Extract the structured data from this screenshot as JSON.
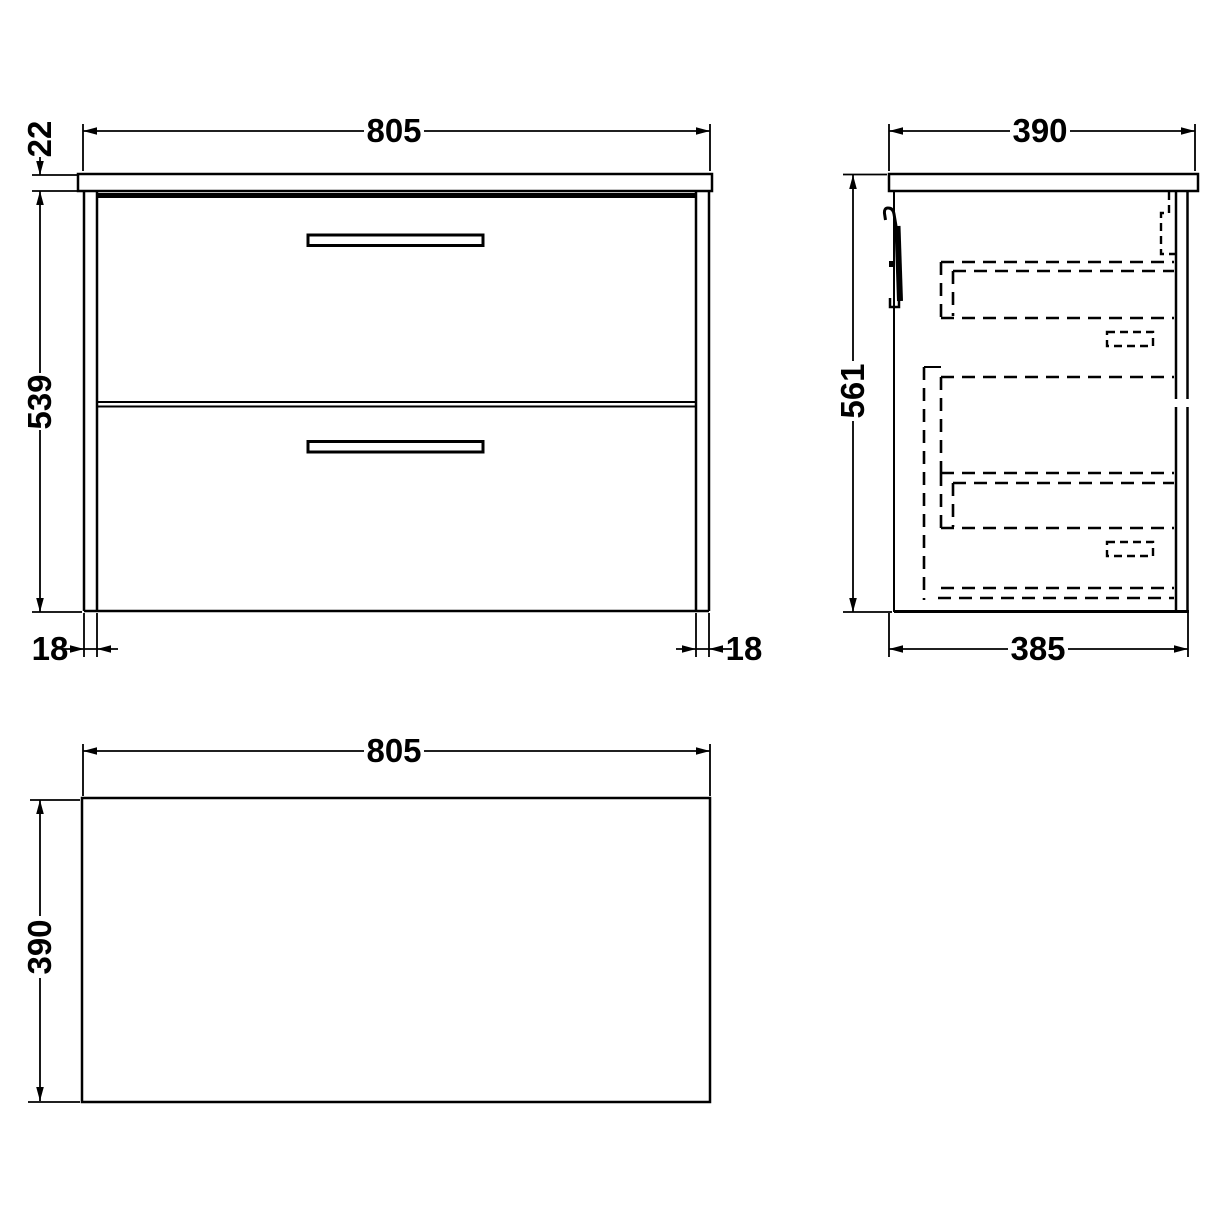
{
  "colors": {
    "line": "#000000",
    "background": "#ffffff"
  },
  "views": {
    "front": {
      "dims": {
        "width": "805",
        "worktop_thickness": "22",
        "cabinet_height": "539",
        "left_panel_thickness": "18",
        "right_panel_thickness": "18"
      }
    },
    "side": {
      "dims": {
        "worktop_depth": "390",
        "overall_height": "561",
        "cabinet_depth": "385"
      }
    },
    "plan": {
      "dims": {
        "width": "805",
        "depth": "390"
      }
    }
  }
}
